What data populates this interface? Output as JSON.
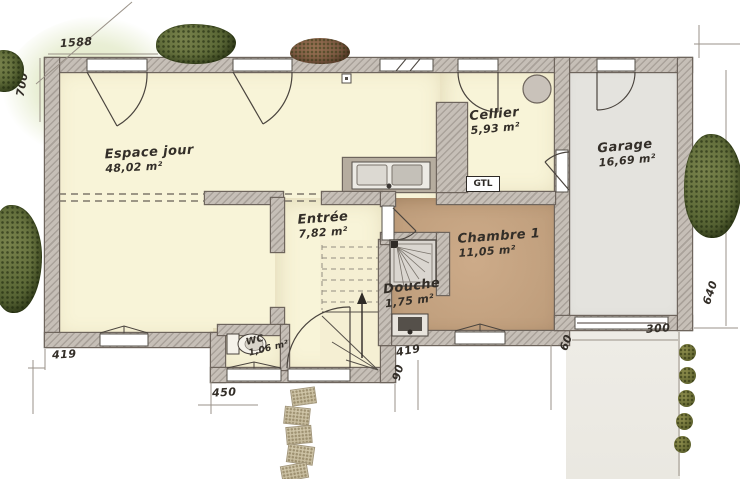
{
  "rooms": [
    {
      "name": "Espace jour",
      "area": "48,02 m²"
    },
    {
      "name": "Cellier",
      "area": "5,93 m²"
    },
    {
      "name": "Garage",
      "area": "16,69 m²"
    },
    {
      "name": "Entrée",
      "area": "7,82 m²"
    },
    {
      "name": "Chambre 1",
      "area": "11,05 m²"
    },
    {
      "name": "Douche",
      "area": "1,75 m²"
    },
    {
      "name": "WC",
      "area": "1,06 m²"
    }
  ],
  "labels": {
    "gtl": "GTL"
  },
  "dimensions": {
    "top": "1588",
    "left": "700",
    "bottom_left": "419",
    "wc_block": "450",
    "entry_bottom": "419",
    "entry_step": "90",
    "garage_offset": "60",
    "garage_side": "640",
    "driveway": "300"
  },
  "colors": {
    "floor_day": "#f8f4d8",
    "floor_bedroom": "#c3a282",
    "floor_garage": "#e4e3de",
    "wall": "#c6bfb7",
    "line": "#4a443e",
    "greenery": "#5c6937"
  }
}
